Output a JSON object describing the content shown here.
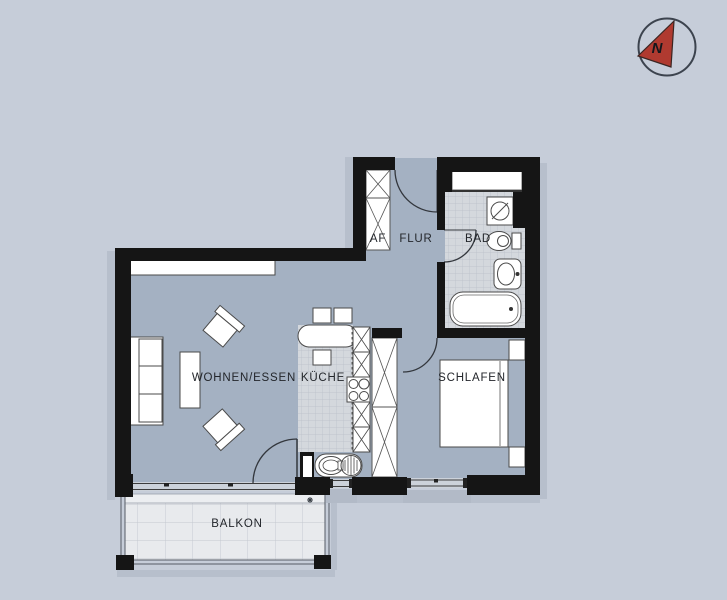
{
  "meta": {
    "drawing_type": "apartment floor plan",
    "language": "de"
  },
  "colors": {
    "background": "#c6cdd9",
    "floor": "#a4b1c2",
    "tile_floor": "#d4d8dd",
    "tile_line": "#b9bfc8",
    "balcony_floor": "#e8eaed",
    "wall": "#151515",
    "furniture_fill": "#ffffff",
    "furniture_stroke": "#4a4a4a",
    "window_sill": "#b2bac7",
    "shadow": "#b7bfcc",
    "north_arrow_red": "#b03a30"
  },
  "north": {
    "label": "N"
  },
  "rooms": {
    "living": {
      "label": "WOHNEN/ESSEN"
    },
    "kitchen": {
      "label": "KÜCHE"
    },
    "hall": {
      "label": "FLUR"
    },
    "storage": {
      "label": "AF"
    },
    "bath": {
      "label": "BAD"
    },
    "bedroom": {
      "label": "SCHLAFEN"
    },
    "balcony": {
      "label": "BALKON"
    }
  }
}
